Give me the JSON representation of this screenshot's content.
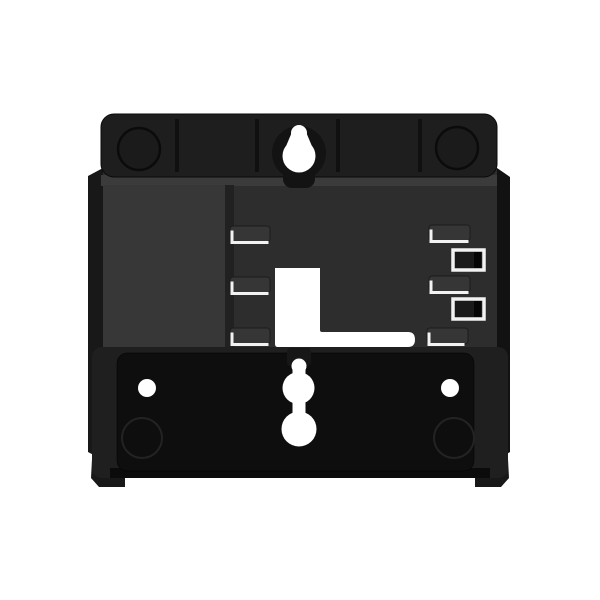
{
  "scene": {
    "description": "Black plastic wall-mount bracket for a desk phone, photographed face-on, centered on a plain white background",
    "subject": "wall-mount-bracket",
    "text_visible": ""
  },
  "colors": {
    "background": "#ffffff",
    "cutout": "#ffffff",
    "top_bar": "#1e1e1e",
    "body": "#2e2e2e",
    "bottom_panel": "#0e0e0e",
    "highlight": "#f2f2f2"
  },
  "features": {
    "top_keyhole_count": 1,
    "bottom_keyhole_count": 1,
    "screw_hole_count": 2,
    "left_tab_count": 3,
    "right_tab_count": 3,
    "right_slot_count": 2,
    "molded_circle_count": 4
  }
}
